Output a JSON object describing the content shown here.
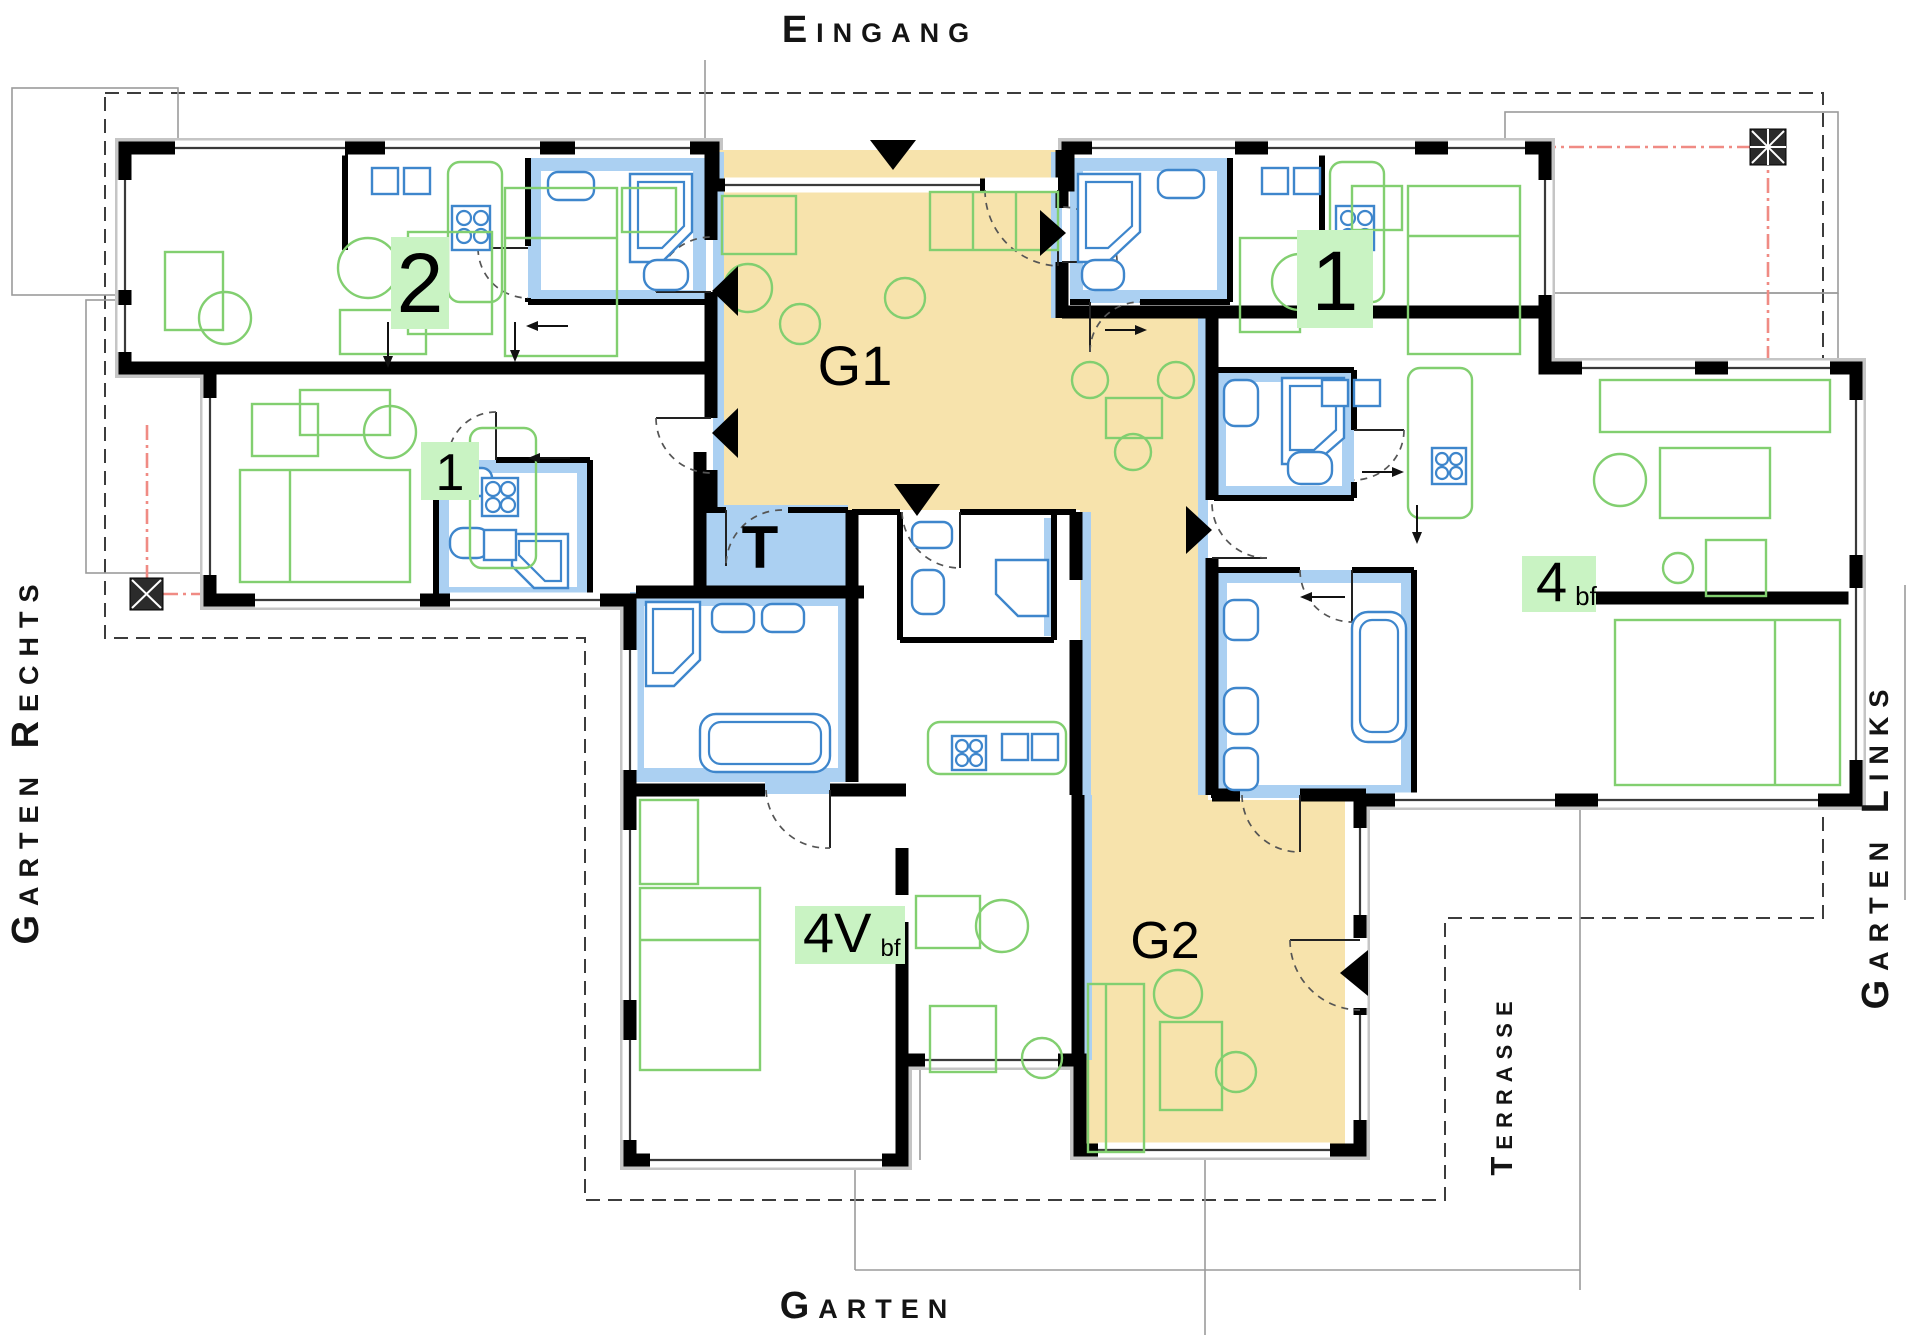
{
  "plan": {
    "description": "Architectural ground floor plan of a residential building",
    "site_labels": {
      "top": "Eingang",
      "left": "Garten Rechts",
      "right": "Garten Links",
      "terrace": "Terrasse",
      "bottom": "Garten"
    },
    "rooms": {
      "g1": "G1",
      "g2": "G2",
      "t": "T"
    },
    "units": {
      "u2": {
        "number": "2"
      },
      "u1r": {
        "number": "1"
      },
      "u1l": {
        "number": "1"
      },
      "u4": {
        "number": "4",
        "suffix": "bf"
      },
      "u4v": {
        "number": "4V",
        "suffix": "bf"
      }
    },
    "colors": {
      "corridor": "#F7E3AC",
      "wet_room": "#ABD0F2",
      "fixture_outline": "#3E86CC",
      "furniture_outline": "#82CF70",
      "unit_label_bg": "#C9F3C3",
      "wall": "#000000",
      "casing": "#C5C5C5",
      "boundary_dash": "#3C3C3C",
      "canopy_red": "#F08B84"
    }
  }
}
